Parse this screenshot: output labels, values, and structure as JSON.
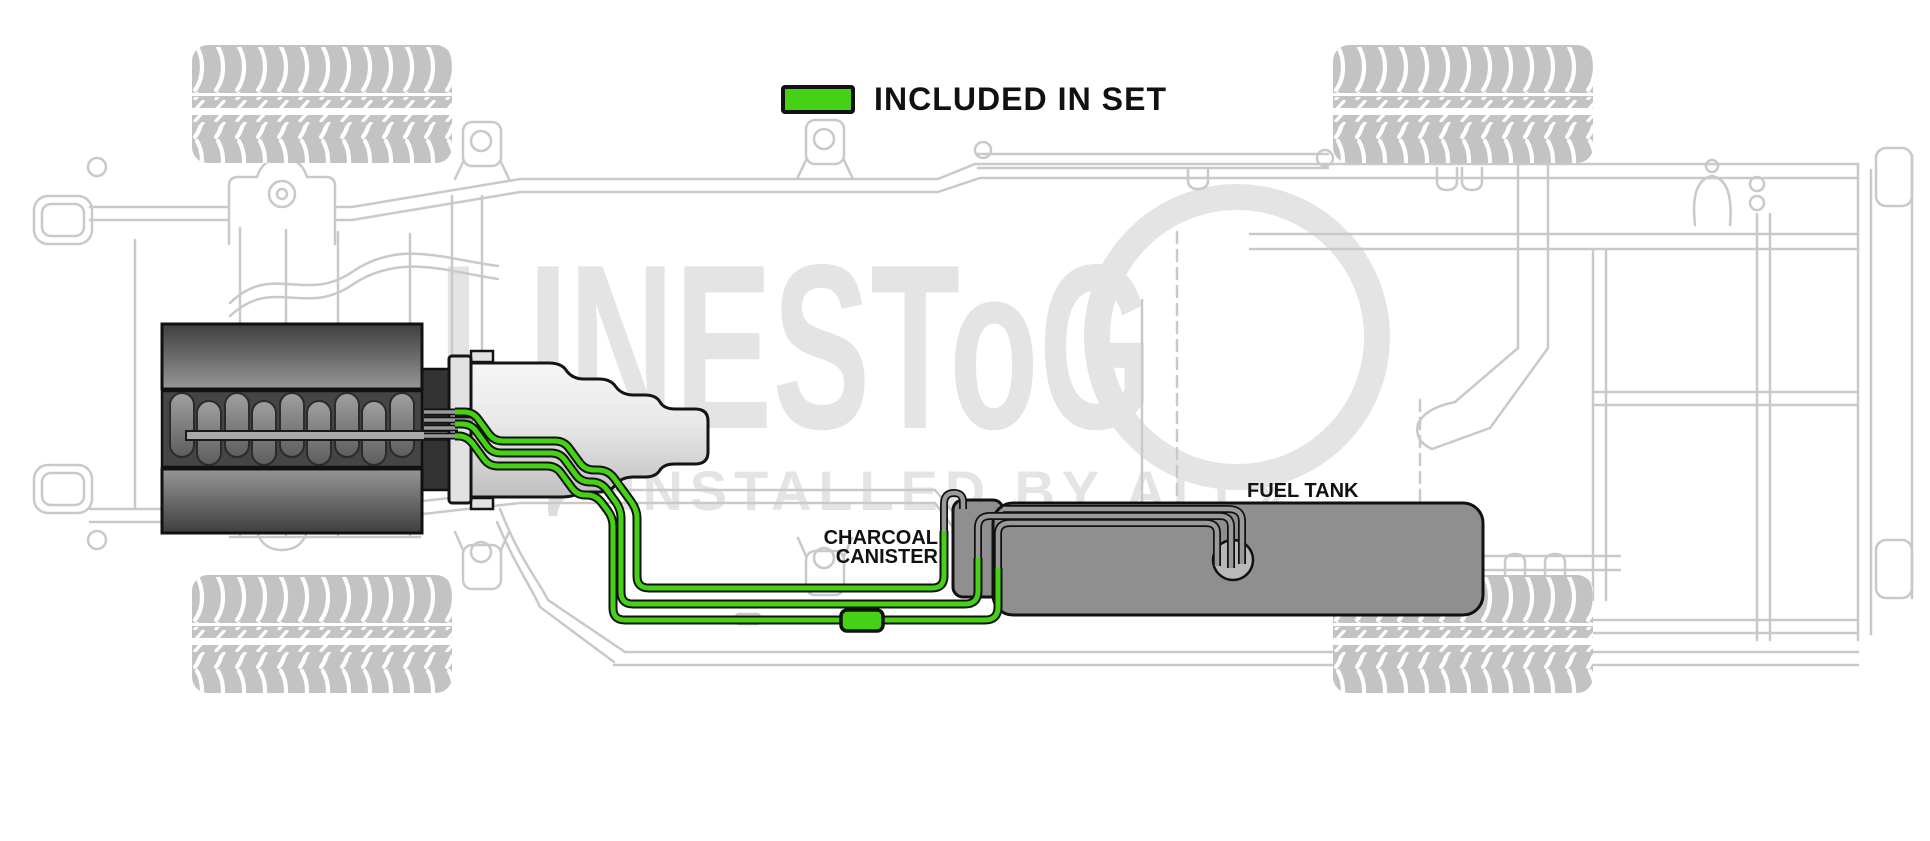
{
  "legend": {
    "label": "INCLUDED IN SET"
  },
  "labels": {
    "charcoal_line1": "CHARCOAL",
    "charcoal_line2": "CANISTER",
    "fuel_tank": "FUEL TANK"
  },
  "watermark": {
    "brand_text": "LINESToG",
    "tagline": "INSTALLED BY ALL",
    "arrow": "»"
  },
  "colors": {
    "included_green": "#46d214",
    "oem_line_gray": "#9a9a9a",
    "outline_black": "#111111",
    "tank_gray": "#8f8f8f",
    "pump_gray": "#b9b9b9",
    "chassis_gray": "#c9c9c9",
    "watermark_gray": "#e4e4e4",
    "tire_gray": "#c3c3c3"
  }
}
